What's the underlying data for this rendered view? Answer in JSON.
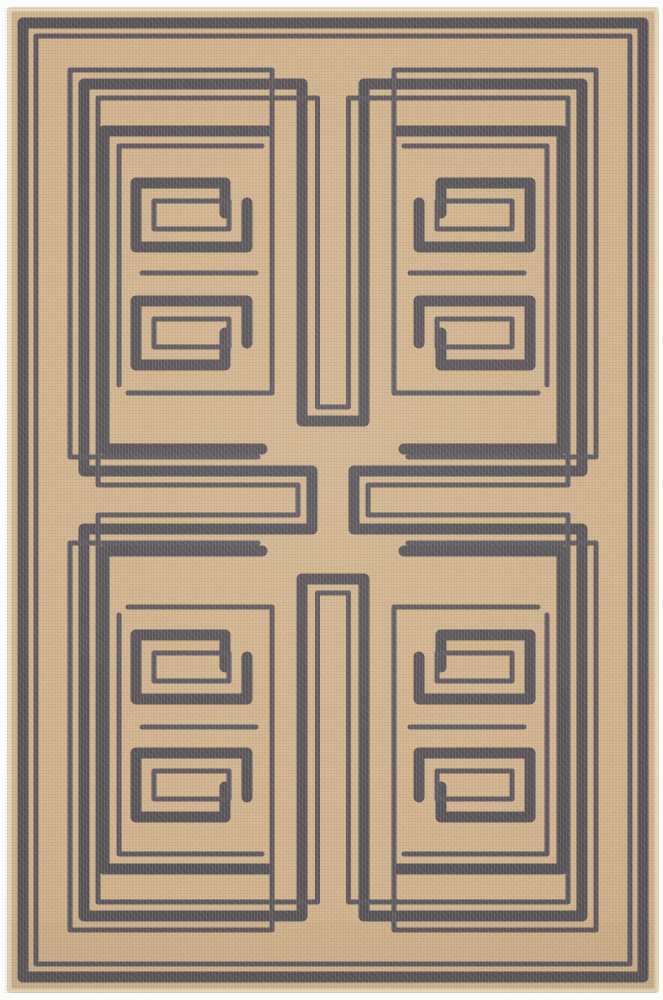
{
  "meta": {
    "subject": "flat-weave area rug, tan field with dark charcoal Greek-key labyrinth maze pattern, photographed on white background"
  },
  "palette": {
    "background": "#fbfbf9",
    "rug_tan": "#c7a67d",
    "rug_tan_deep": "#bb9b73",
    "line_dark": "#35323b",
    "line_thin": "#3d3944",
    "edge_binding": "#e2d2ad",
    "edge_shadow": "#d8d4cc"
  },
  "rug": {
    "x": 8,
    "y": 8,
    "width": 650,
    "height": 984,
    "corner_radius": 3,
    "stroke_thick": 11,
    "stroke_thin": 5
  },
  "artwork": {
    "shared_paths": [
      {
        "name": "outer-border-thick",
        "weight": "thick",
        "d": "M23,23 H643 V977 H23 Z"
      },
      {
        "name": "outer-border-thin",
        "weight": "thin",
        "d": "M36,36 H630 V964 H36 Z"
      },
      {
        "name": "labyrinth-loop-thick-with-tongues",
        "weight": "thick",
        "d": "M84,84 H302 V421 H364 V84 H582 V471 H354 V529 H582 V916 H364 V579 H302 V916 H84 V529 H312 V471 H84 Z"
      },
      {
        "name": "labyrinth-loop-thin-inner-with-tongues",
        "weight": "thin",
        "d": "M98,98 H317.5 V407 H348.5 V98 H568 V485 H368 V515 H568 V902 H348.5 V593 H317.5 V902 H98 V515 H298 V485 H98 Z"
      }
    ],
    "quadrant_paths": [
      {
        "name": "spiral-ring-thick",
        "weight": "thick",
        "d": "M268,131 H104 V449 H262"
      },
      {
        "name": "hook-upper-thick",
        "weight": "thick",
        "d": "M225,213 V183 H136 V247 H247 V203"
      },
      {
        "name": "hook-lower-thick",
        "weight": "thick",
        "d": "M225,333 V365 H136 V301 H247 V343"
      },
      {
        "name": "spiral-ring-thin",
        "weight": "thin",
        "d": "M262,146 H119 V385"
      },
      {
        "name": "outer-thin-with-dive",
        "weight": "thin",
        "d": "M258,457 H70 V70 H272 V393 H128"
      },
      {
        "name": "hook-upper-thin-inner",
        "weight": "thin",
        "d": "M229,201 H154 V229 H229 Z"
      },
      {
        "name": "hook-lower-thin-inner",
        "weight": "thin",
        "d": "M229,347 H154 V319 H229 Z"
      },
      {
        "name": "between-hooks-thin",
        "weight": "thin",
        "d": "M256,273 H142"
      }
    ],
    "quadrant_transforms": [
      "",
      "translate(666,0) scale(-1,1)",
      "translate(0,1000) scale(1,-1)",
      "translate(666,1000) scale(-1,-1)"
    ]
  }
}
